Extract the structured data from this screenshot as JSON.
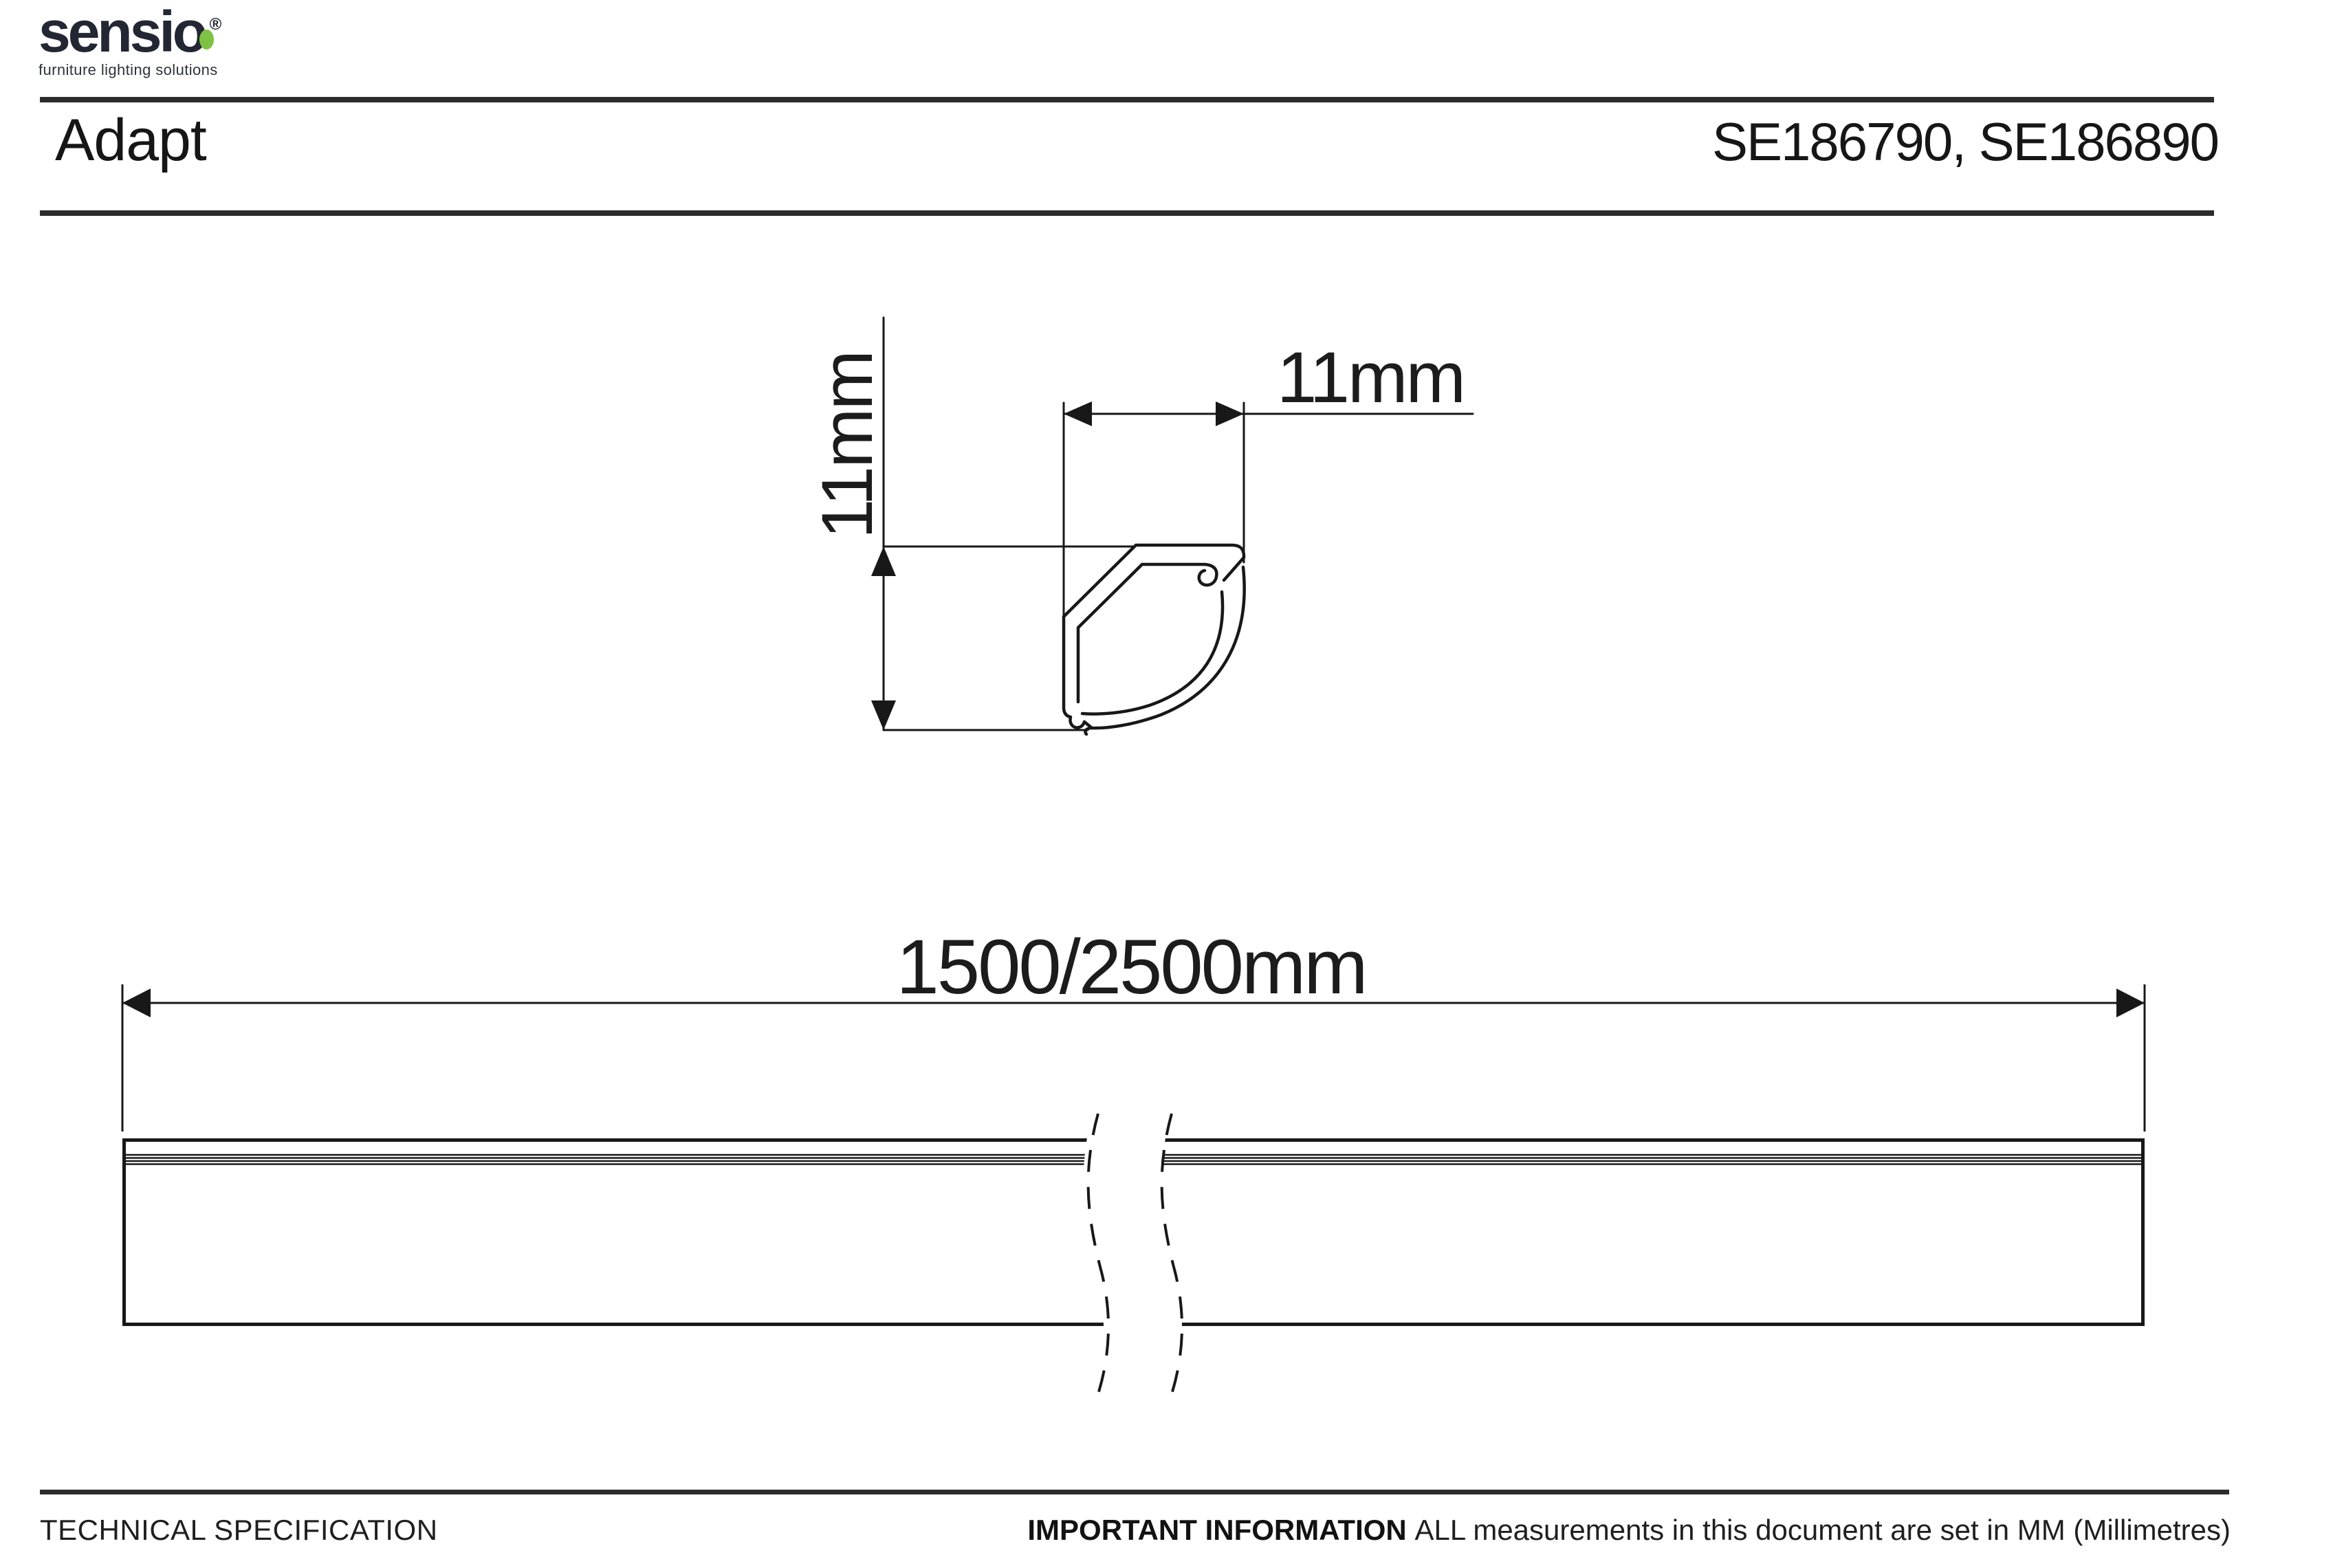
{
  "brand": {
    "name": "sensio",
    "registered_mark": "®",
    "tagline": "furniture lighting solutions"
  },
  "header": {
    "product_name": "Adapt",
    "product_codes": "SE186790, SE186890"
  },
  "drawings": {
    "cross_section": {
      "height_dimension": "11mm",
      "width_dimension": "11mm"
    },
    "profile_length": {
      "length_dimension": "1500/2500mm"
    }
  },
  "footer": {
    "section_label": "TECHNICAL SPECIFICATION",
    "important_label": "IMPORTANT INFORMATION",
    "important_text": "ALL measurements in this document are set in MM (Millimetres)"
  },
  "colors": {
    "logo_dark": "#232733",
    "logo_green": "#7dc242",
    "rule_dark": "#2c2c2c",
    "drawing_ink": "#181818"
  }
}
